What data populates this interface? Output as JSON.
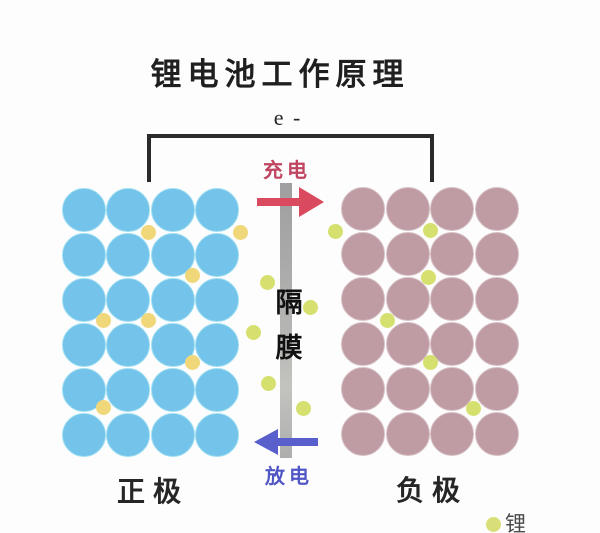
{
  "title": "锂电池工作原理",
  "circuit": {
    "electron_label": "e -",
    "wire_color": "#2b2b2b"
  },
  "charge": {
    "label": "充电",
    "text_color": "#bf4560",
    "arrow_color": "#d94a5e"
  },
  "discharge": {
    "label": "放电",
    "text_color": "#5057c5",
    "arrow_color": "#5a60cb"
  },
  "separator": {
    "label": "隔膜",
    "chars": [
      "隔",
      "膜"
    ],
    "bar_color": "#ababab"
  },
  "electrodes": {
    "left": {
      "label": "正极",
      "circle_color": "#73c3ea",
      "edge_color": "#9edff2",
      "rows": 6,
      "cols": 4,
      "origin_x": 84,
      "origin_y": 210,
      "pitch_x": 44.4,
      "pitch_y": 45,
      "diameter": 44
    },
    "right": {
      "label": "负极",
      "circle_color": "#bf9ca3",
      "edge_color": "#d7c2c6",
      "rows": 6,
      "cols": 4,
      "origin_x": 363,
      "origin_y": 209,
      "pitch_x": 44.7,
      "pitch_y": 45,
      "diameter": 44
    }
  },
  "ions": {
    "gold_color": "#f0d87a",
    "green_color": "#d6e06f",
    "diameter": 15,
    "positions": [
      {
        "x": 148,
        "y": 232,
        "c": "gold"
      },
      {
        "x": 240,
        "y": 232,
        "c": "gold"
      },
      {
        "x": 192,
        "y": 275,
        "c": "gold"
      },
      {
        "x": 103,
        "y": 320,
        "c": "gold"
      },
      {
        "x": 148,
        "y": 320,
        "c": "gold"
      },
      {
        "x": 192,
        "y": 362,
        "c": "gold"
      },
      {
        "x": 103,
        "y": 407,
        "c": "gold"
      },
      {
        "x": 267,
        "y": 282,
        "c": "green"
      },
      {
        "x": 310,
        "y": 307,
        "c": "green"
      },
      {
        "x": 253,
        "y": 332,
        "c": "green"
      },
      {
        "x": 268,
        "y": 383,
        "c": "green"
      },
      {
        "x": 303,
        "y": 408,
        "c": "green"
      },
      {
        "x": 335,
        "y": 231,
        "c": "green"
      },
      {
        "x": 430,
        "y": 230,
        "c": "green"
      },
      {
        "x": 428,
        "y": 277,
        "c": "green"
      },
      {
        "x": 387,
        "y": 320,
        "c": "green"
      },
      {
        "x": 430,
        "y": 362,
        "c": "green"
      },
      {
        "x": 473,
        "y": 408,
        "c": "green"
      }
    ]
  },
  "legend": {
    "label": "锂",
    "dot_color": "#d8df78",
    "text_color": "#4a4a4a"
  }
}
